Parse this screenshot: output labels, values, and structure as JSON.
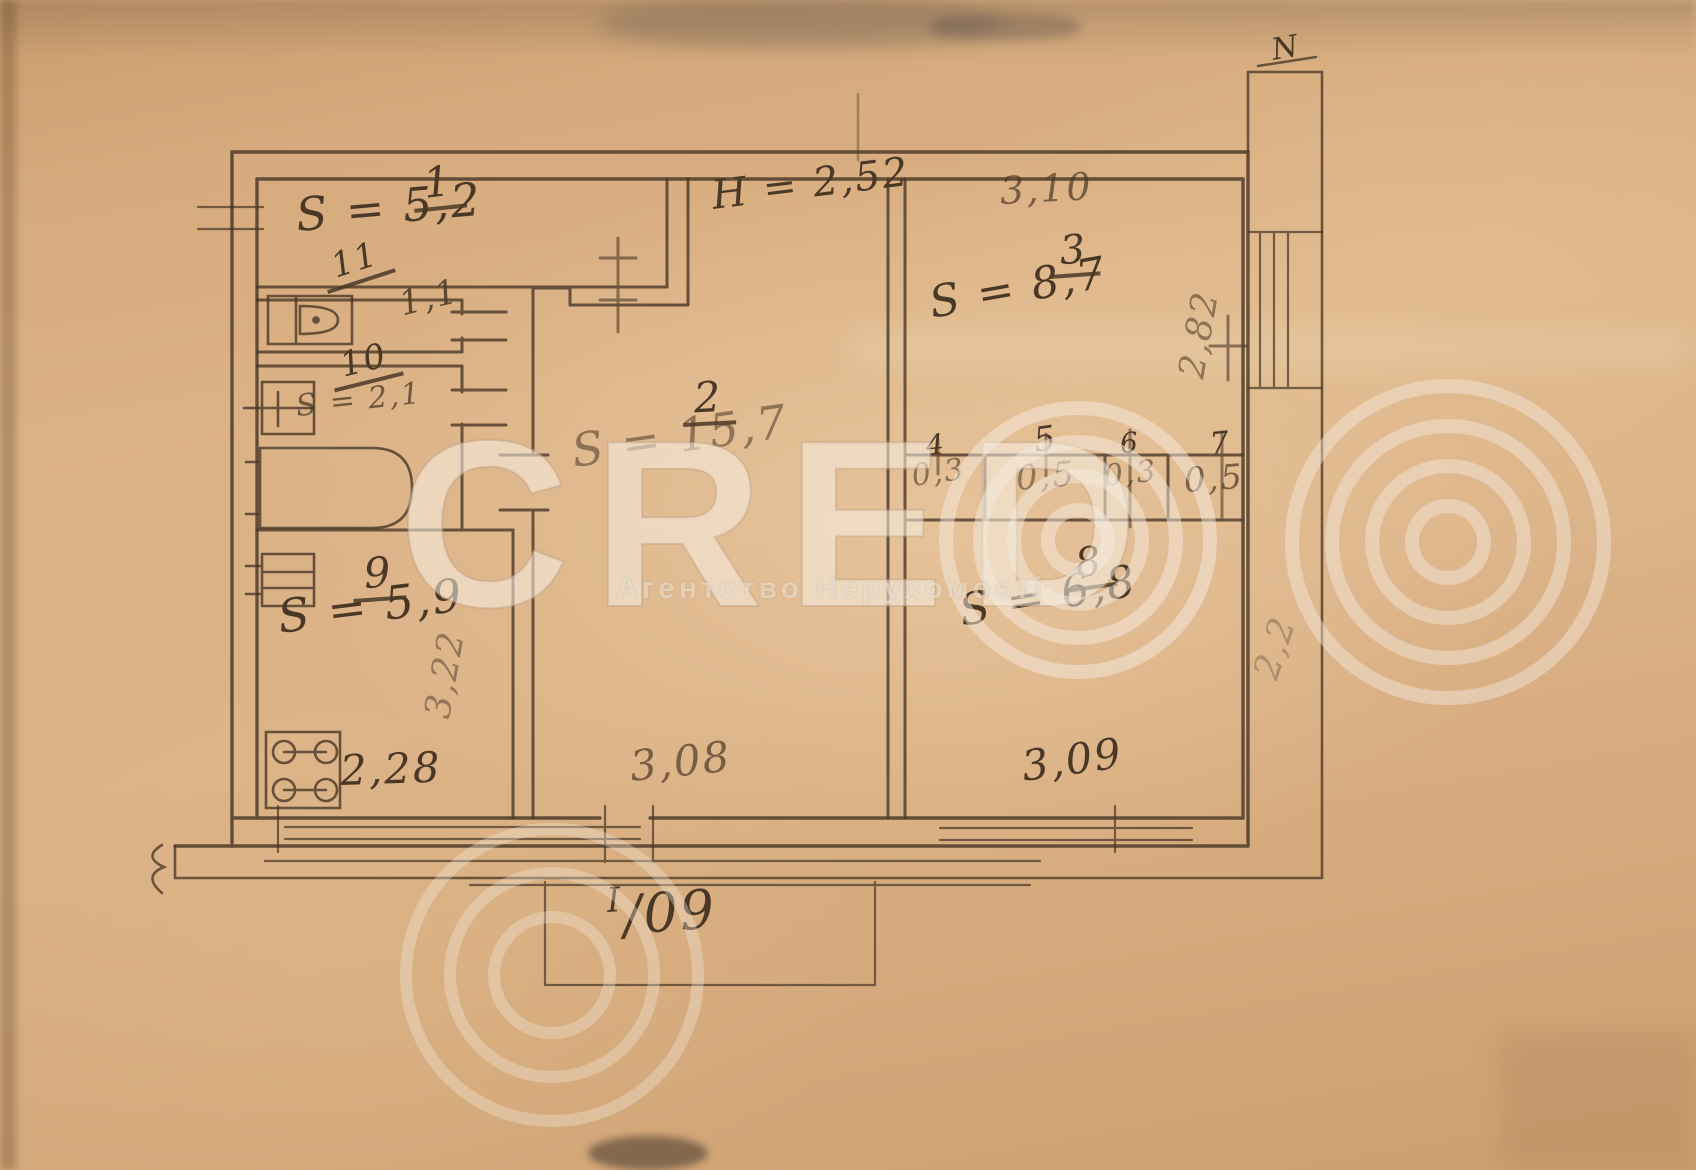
{
  "watermark": {
    "brand_letters": "CRED",
    "brand_symbol": "concentric-circles-O",
    "subtitle": "Агентство Нерухомості"
  },
  "plan": {
    "north_mark": "N",
    "ceiling_height": "H = 2,52",
    "entrance_mark": {
      "upper": "I",
      "lower": "/09"
    },
    "rooms": [
      {
        "number": "1",
        "area": "S = 5,2"
      },
      {
        "number": "2",
        "area": "S = 15,7"
      },
      {
        "number": "3",
        "area": "S = 8,7"
      },
      {
        "number": "4",
        "area": "0,3"
      },
      {
        "number": "5",
        "area": "0,5"
      },
      {
        "number": "6",
        "area": "0,3"
      },
      {
        "number": "7",
        "area": "0,5"
      },
      {
        "number": "8",
        "area": "S = 6,8"
      },
      {
        "number": "9",
        "area": "S = 5,9"
      },
      {
        "number": "10",
        "area": "S = 2,1"
      },
      {
        "number": "11",
        "area": "1,1"
      }
    ],
    "dimensions": {
      "room3_width": "3,10",
      "room3_depth": "2,82",
      "room8_width": "3,09",
      "room8_depth": "2,2",
      "room2_width": "3,08",
      "room9_width": "2,28",
      "room9_depth": "3,22"
    }
  },
  "colors": {
    "paper": "#dbb287",
    "pencil": "#4a3826",
    "watermark": "rgba(244,236,223,0.45)"
  }
}
